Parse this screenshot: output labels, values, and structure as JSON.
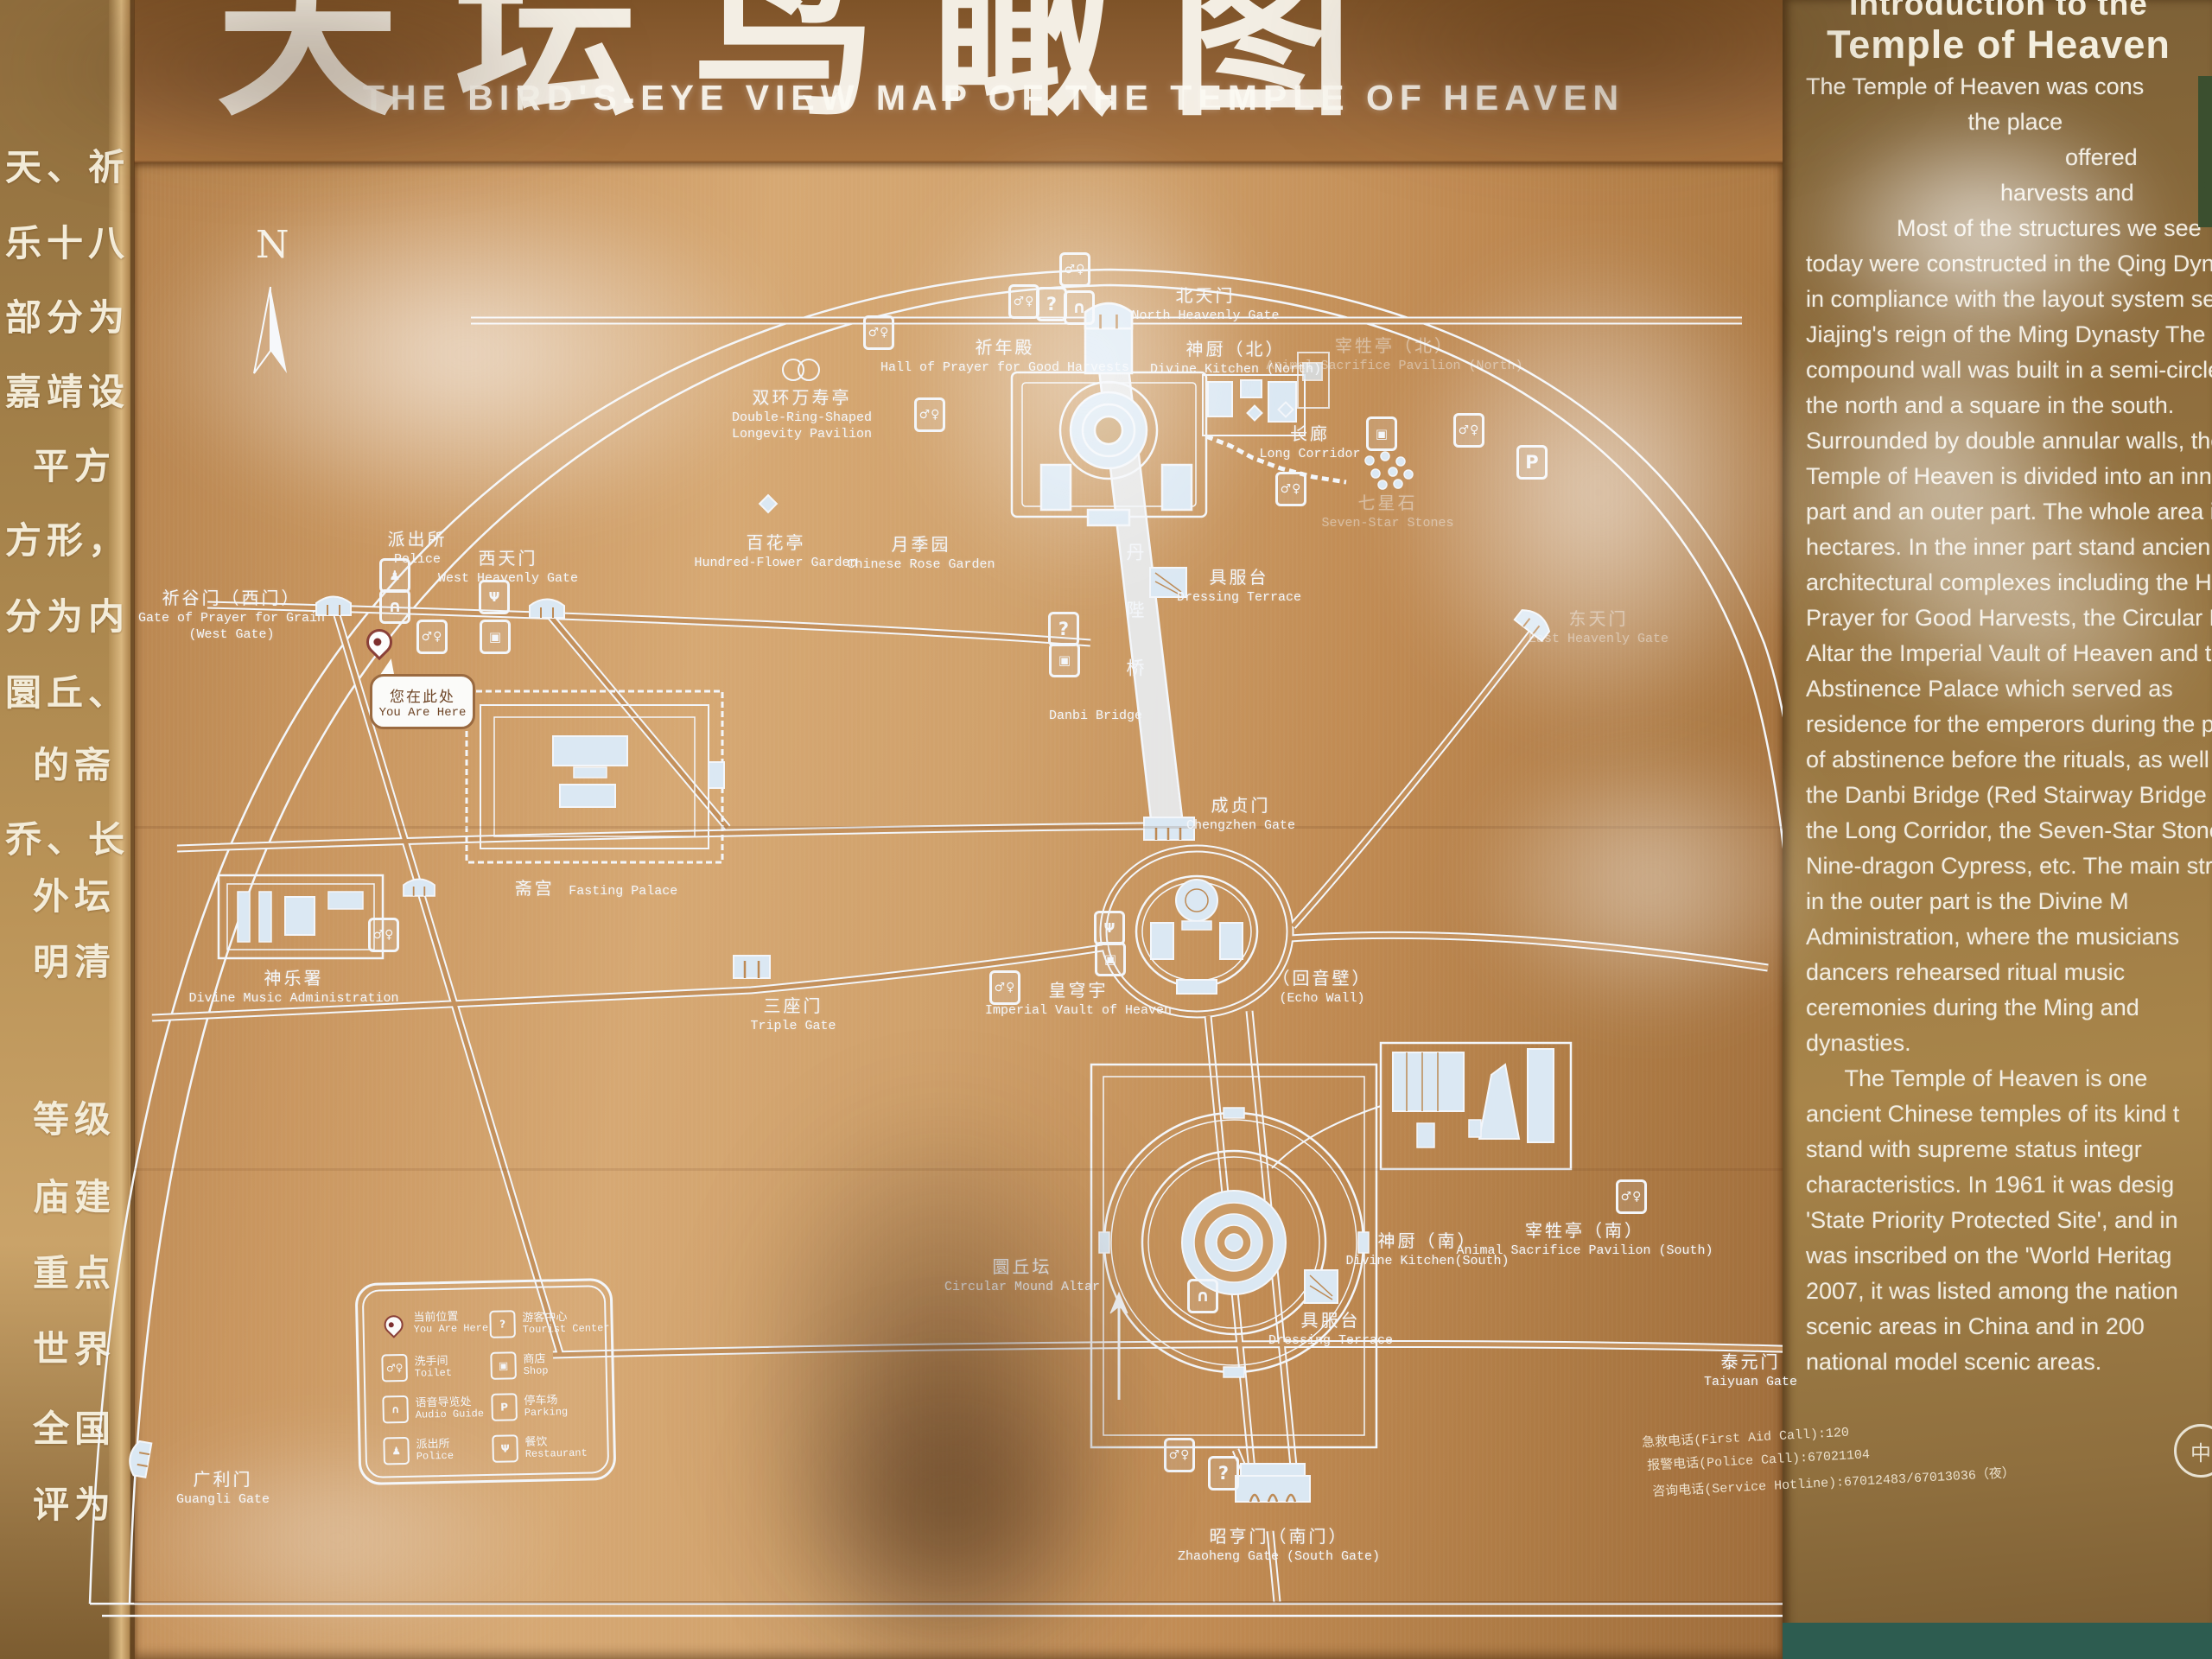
{
  "colors": {
    "copper": "#c9965f",
    "map_line": "#f3f6fa",
    "building_fill": "#dbe8f3",
    "pin_red": "#8a2f2f",
    "panel_text": "#f2ede2",
    "teal_frame": "#2d5c50"
  },
  "title": {
    "cn_calligraphy": "天坛鸟瞰图",
    "en": "THE BIRD'S-EYE VIEW MAP OF THE TEMPLE OF HEAVEN"
  },
  "left_strip": {
    "rows": [
      "天、祈",
      "乐十八",
      "部分为",
      "嘉靖设",
      "平方",
      "方形，",
      "分为内",
      "圜丘、",
      "的斋",
      "乔、长",
      "外坛",
      "明清",
      "等级",
      "庙建",
      "重点",
      "世界",
      "全国",
      "评为"
    ]
  },
  "compass": {
    "label": "N"
  },
  "icons": {
    "glyphs": {
      "toilet": "♂♀",
      "info": "?",
      "audio": "∩",
      "police": "♟",
      "restaurant": "Ψ",
      "shop": "▣",
      "parking": "P"
    }
  },
  "map": {
    "danbi": {
      "cn": "丹陛桥",
      "en": "Danbi Bridge"
    },
    "you_are_here": {
      "cn": "您在此处",
      "en": "You Are Here"
    },
    "labels": [
      {
        "cn": "北天门",
        "en": "North Heavenly Gate"
      },
      {
        "cn": "祈年殿",
        "en": "Hall of Prayer for Good Harvests"
      },
      {
        "cn": "神厨（北）",
        "en": "Divine Kitchen (North)"
      },
      {
        "cn": "长廊",
        "en": "Long Corridor"
      },
      {
        "cn": "宰牲亭（北）",
        "en": "Animal Sacrifice Pavilion (North)"
      },
      {
        "cn": "七星石",
        "en": "Seven-Star Stones"
      },
      {
        "cn": "东天门",
        "en": "East Heavenly Gate"
      },
      {
        "cn": "双环万寿亭",
        "en": "Double-Ring-Shaped",
        "en2": "Longevity Pavilion"
      },
      {
        "cn": "百花亭",
        "en": "Hundred-Flower Garden"
      },
      {
        "cn": "月季园",
        "en": "Chinese Rose Garden"
      },
      {
        "cn": "派出所",
        "en": "Police"
      },
      {
        "cn": "西天门",
        "en": "West Heavenly Gate"
      },
      {
        "cn": "祈谷门（西门）",
        "en": "Gate of Prayer for Grain",
        "en2": "(West Gate)"
      },
      {
        "cn": "斋宫",
        "en": "Fasting Palace"
      },
      {
        "cn": "神乐署",
        "en": "Divine Music Administration"
      },
      {
        "cn": "三座门",
        "en": "Triple Gate"
      },
      {
        "cn": "具服台",
        "en": "Dressing Terrace"
      },
      {
        "cn": "成贞门",
        "en": "Chengzhen Gate"
      },
      {
        "cn": "皇穹宇",
        "en": "Imperial Vault of Heaven"
      },
      {
        "cn": "（回音壁）",
        "en": "(Echo Wall)"
      },
      {
        "cn": "圜丘坛",
        "en": "Circular Mound Altar"
      },
      {
        "cn": "神厨（南）",
        "en": "Divine Kitchen(South)"
      },
      {
        "cn": "宰牲亭（南）",
        "en": "Animal Sacrifice Pavilion (South)"
      },
      {
        "cn": "具服台",
        "en": "Dressing Terrace"
      },
      {
        "cn": "泰元门",
        "en": "Taiyuan Gate"
      },
      {
        "cn": "昭亨门（南门）",
        "en": "Zhaoheng Gate (South Gate)"
      },
      {
        "cn": "广利门",
        "en": "Guangli Gate"
      }
    ]
  },
  "legend": {
    "items": [
      {
        "type": "pin",
        "cn": "当前位置",
        "en": "You Are Here"
      },
      {
        "type": "info",
        "cn": "游客中心",
        "en": "Tourist Center"
      },
      {
        "type": "toilet",
        "cn": "洗手间",
        "en": "Toilet"
      },
      {
        "type": "shop",
        "cn": "商店",
        "en": "Shop"
      },
      {
        "type": "audio",
        "cn": "语音导览处",
        "en": "Audio Guide"
      },
      {
        "type": "parking",
        "cn": "停车场",
        "en": "Parking"
      },
      {
        "type": "police",
        "cn": "派出所",
        "en": "Police"
      },
      {
        "type": "restaurant",
        "cn": "餐饮",
        "en": "Restaurant"
      }
    ]
  },
  "contacts": {
    "lines": [
      "急救电话(First Aid Call):120",
      "报警电话(Police Call):67021104",
      "咨询电话(Service Hotline):67012483/67013036（夜）"
    ]
  },
  "intro_panel": {
    "heading_line1": "Introduction to the",
    "heading_line2": "Temple of Heaven",
    "logo_text": "中",
    "lines": [
      "The Temple of Heaven was cons",
      "                         the place",
      "",
      "",
      "                                        offered",
      "                              harvests and",
      "              Most of the structures we see",
      "today were constructed in the Qing Dynasty",
      "in compliance with the layout system set in",
      "Jiajing's reign of the Ming Dynasty The",
      "compound wall was built in a semi-circle in",
      "the north and a square in the south.",
      "Surrounded by double annular walls, the",
      "Temple of Heaven is divided into an inner",
      "part and an outer part. The whole area is 273",
      "hectares. In the inner part stand ancien",
      "architectural complexes including the Hall o",
      "Prayer for Good Harvests, the Circular Moun",
      "Altar the Imperial Vault of Heaven and th",
      "Abstinence Palace which served as",
      "residence for the emperors during the peri",
      "of abstinence before the rituals, as well",
      "the Danbi Bridge (Red Stairway Bridge",
      "the Long Corridor, the Seven-Star Stones,",
      "Nine-dragon Cypress, etc. The main struc",
      "in the outer part is the Divine M",
      "Administration, where the musicians",
      "dancers rehearsed ritual music",
      "ceremonies during the Ming and",
      "dynasties.",
      "      The Temple of Heaven is one",
      "ancient Chinese temples of its kind t",
      "stand with supreme status integr",
      "characteristics. In 1961 it was desig",
      "'State Priority Protected Site', and in",
      "was inscribed on the 'World Heritag",
      "2007, it was listed among the nation",
      "scenic areas in China and in 200",
      "national model scenic areas."
    ]
  }
}
